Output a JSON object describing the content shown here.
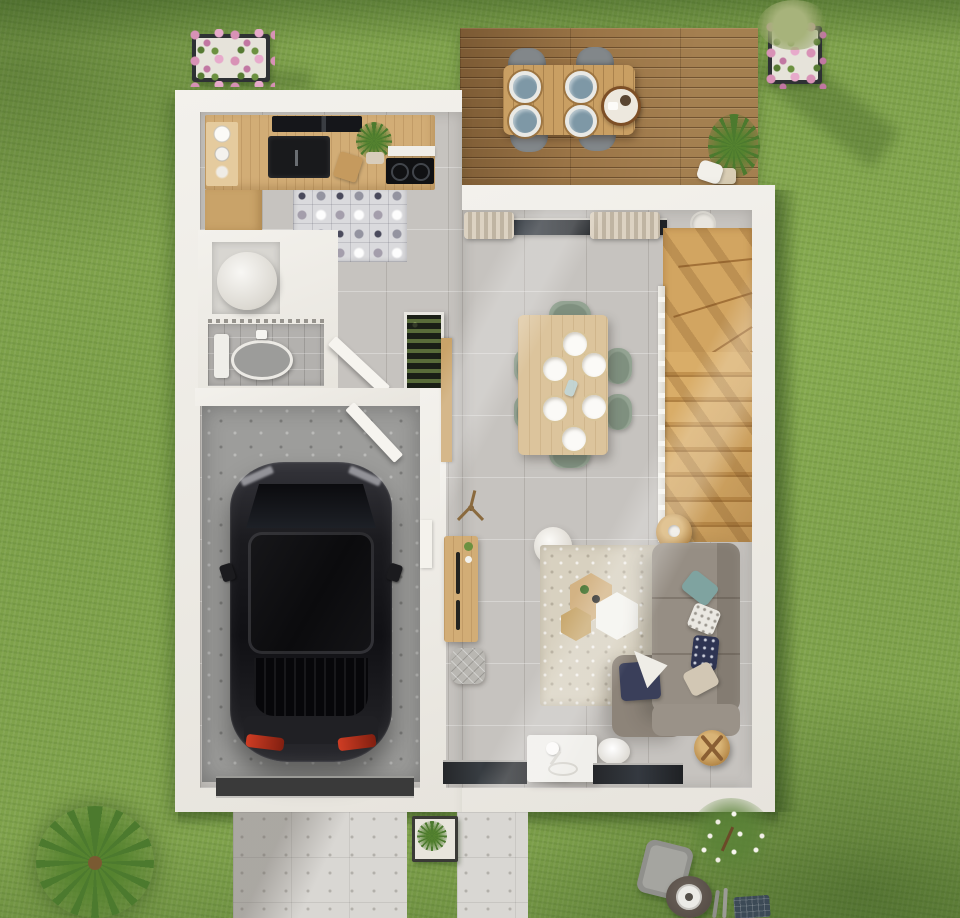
{
  "scene": {
    "title": "3D floor-plan render — ground floor with garage, kitchen, WC and open living-dining room",
    "view": "top-down architectural visualization",
    "environment": {
      "lawn": "grass lawn surrounding the house",
      "deck": "wooden terrace with outdoor dining set for four",
      "driveway": "concrete driveway in front of the garage",
      "front_path": "paved walkway to the entrance",
      "planters": [
        {
          "location": "top-left",
          "contents": "pink flower box"
        },
        {
          "location": "top-right",
          "contents": "pink flowers with green shrub"
        },
        {
          "location": "by-walkway",
          "contents": "green shrub planter"
        }
      ],
      "garden_objects": [
        "palm bush",
        "white flowering shrub",
        "sun lounger",
        "round garden table with bowl",
        "garden tools",
        "blue seed tray"
      ]
    },
    "rooms": [
      {
        "name": "kitchen",
        "items": [
          "wood worktop",
          "black sink",
          "cooktop",
          "range hood",
          "open shelf",
          "stacked dishes",
          "potted plant",
          "patchwork tile rug",
          "base cabinet"
        ]
      },
      {
        "name": "utility closet",
        "items": [
          "water heater cylinder"
        ]
      },
      {
        "name": "wc",
        "items": [
          "toilet",
          "open door"
        ]
      },
      {
        "name": "hallway",
        "items": [
          "botanical display cabinet",
          "wood wall panel",
          "tripod stool",
          "sideboard",
          "quilted pouf"
        ]
      },
      {
        "name": "garage",
        "items": [
          "dark sedan car",
          "garage door",
          "service door"
        ]
      },
      {
        "name": "living-dining room",
        "items": [
          "sliding bay window with curtains",
          "winder staircase with balustrade",
          "dining table for six",
          "six sage chairs",
          "six place settings",
          "paper floor lamp",
          "berber rug",
          "hexagonal coffee tables",
          "corner sofa",
          "scatter cushions",
          "round side table",
          "round tray table",
          "white desk with lamp",
          "floor-level windows"
        ]
      }
    ],
    "palette": {
      "grass": "#7fa24b",
      "deck_wood": "#9a7446",
      "wall_white": "#edebe5",
      "floor_gray": "#c6c3bf",
      "garage_floor": "#9d9d9b",
      "stair_wood": "#d2a561",
      "table_wood": "#dcc49c",
      "chair_sage": "#93a392",
      "sofa_taupe": "#8f867c",
      "rug_beige": "#d8d1c0",
      "car_black": "#1f1f22",
      "flower_pink": "#d792b6",
      "cushion_teal": "#7fa3a0",
      "cushion_navy": "#2f3452",
      "driveway_gray": "#d8d6d2"
    }
  }
}
